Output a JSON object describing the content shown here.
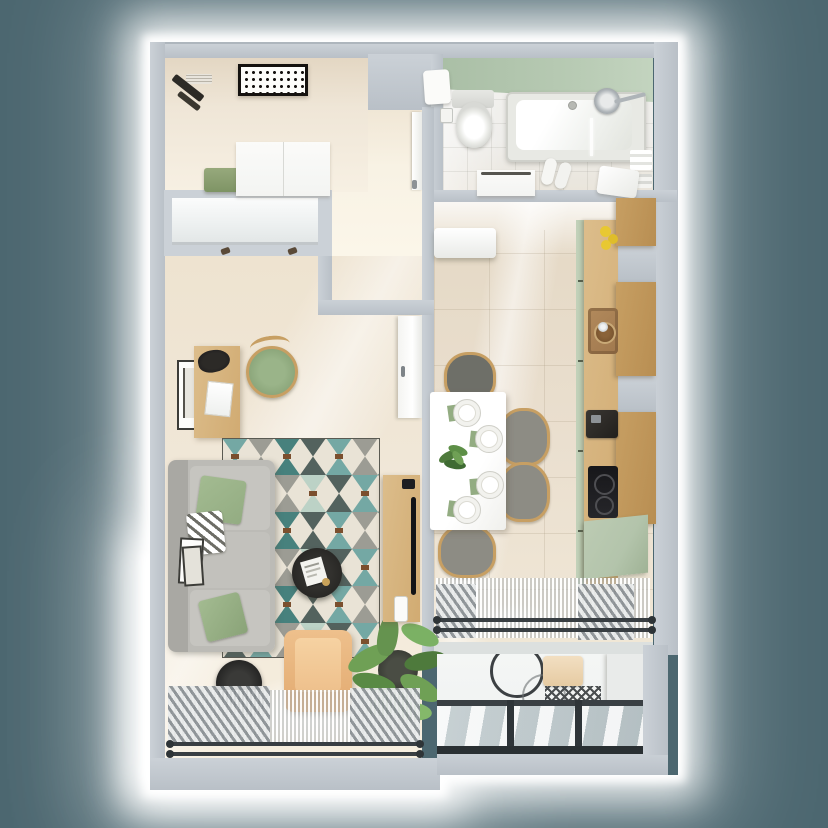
{
  "meta": {
    "scene": "apartment-floor-plan-3d-render",
    "view": "top-down",
    "visible_text": "none"
  },
  "palette": {
    "background": "#4c6770",
    "wall": "#cbd1d7",
    "wall_shadow": "#b9c0c7",
    "hall_floor": "#efe6d7",
    "living_floor": "#f1e8d9",
    "kitchen_floor": "#eadfcf",
    "bath_floor": "#eeedea",
    "bath_accent": "#b7cab3",
    "balcony_floor": "#eff1f0",
    "white": "#f3f4f2",
    "wood": "#dcbd8b",
    "wood_dark": "#c79f63",
    "cabinet_green": "#b3c4ab",
    "sofa_gray": "#bcbbb6",
    "pillow_green": "#93ac82",
    "armchair_tan": "#eec08c",
    "rug_cream": "#e9e3d6",
    "rug_teal": "#74a8a4",
    "rug_teal_dark": "#47817d",
    "rug_gray": "#9c9c94",
    "rug_slate": "#53625e",
    "rug_bar_brown": "#7b4f2e",
    "plant_green": "#659350",
    "dark": "#23272a",
    "chrome": "#aeb4b8",
    "seat_gray": "#85847e",
    "lemon_yellow": "#e8c832",
    "sink_brown": "#a0784e",
    "glass_frame": "#2a3033"
  },
  "rooms": [
    {
      "id": "hallway",
      "label": "Hallway",
      "items": [
        "ceiling-light",
        "ventilation-grille",
        "coat-rack",
        "green-bench",
        "wardrobe"
      ]
    },
    {
      "id": "built-in-closet",
      "label": "Built-in closet",
      "items": [
        "sliding-doors",
        "door-handle",
        "door-handle"
      ]
    },
    {
      "id": "corridor",
      "label": "Corridor",
      "items": [
        "bathroom-door"
      ]
    },
    {
      "id": "bathroom",
      "label": "Bathroom",
      "items": [
        "accent-tile-wall",
        "towel",
        "toilet",
        "toilet-paper-holder",
        "bathtub",
        "shower-head",
        "glass-screen",
        "slippers",
        "vanity-cabinet",
        "towel-shelf",
        "laundry-basket"
      ]
    },
    {
      "id": "kitchen",
      "label": "Kitchen-dining room",
      "items": [
        "air-conditioner",
        "upper-cabinet",
        "upper-cabinet",
        "upper-cabinet",
        "countertop",
        "cabinet-fronts-green",
        "lemons",
        "sink",
        "faucet",
        "coffee-machine",
        "cooktop",
        "base-cabinet-green",
        "dining-table",
        "plate",
        "plate",
        "plate",
        "plate",
        "napkins",
        "table-plant",
        "chair",
        "chair",
        "chair",
        "chair",
        "radiator",
        "sheer-curtain",
        "window-rail"
      ]
    },
    {
      "id": "living-room",
      "label": "Living room",
      "items": [
        "kitchen-door",
        "wall-picture",
        "desk",
        "bag",
        "laptop",
        "desk-chair",
        "geometric-rug",
        "corner-sofa",
        "green-pillow",
        "patterned-pillow",
        "green-pillow",
        "coffee-table",
        "magazine",
        "armchair",
        "floor-lamp",
        "potted-plant",
        "tv-console",
        "tv",
        "remote",
        "leaning-frames",
        "radiator",
        "radiator",
        "sheer-curtain",
        "window-rail"
      ]
    },
    {
      "id": "balcony",
      "label": "Glazed balcony",
      "items": [
        "bicycle",
        "seat-cushion",
        "mesh-basket",
        "glazing-frame",
        "glass-panes"
      ]
    }
  ]
}
